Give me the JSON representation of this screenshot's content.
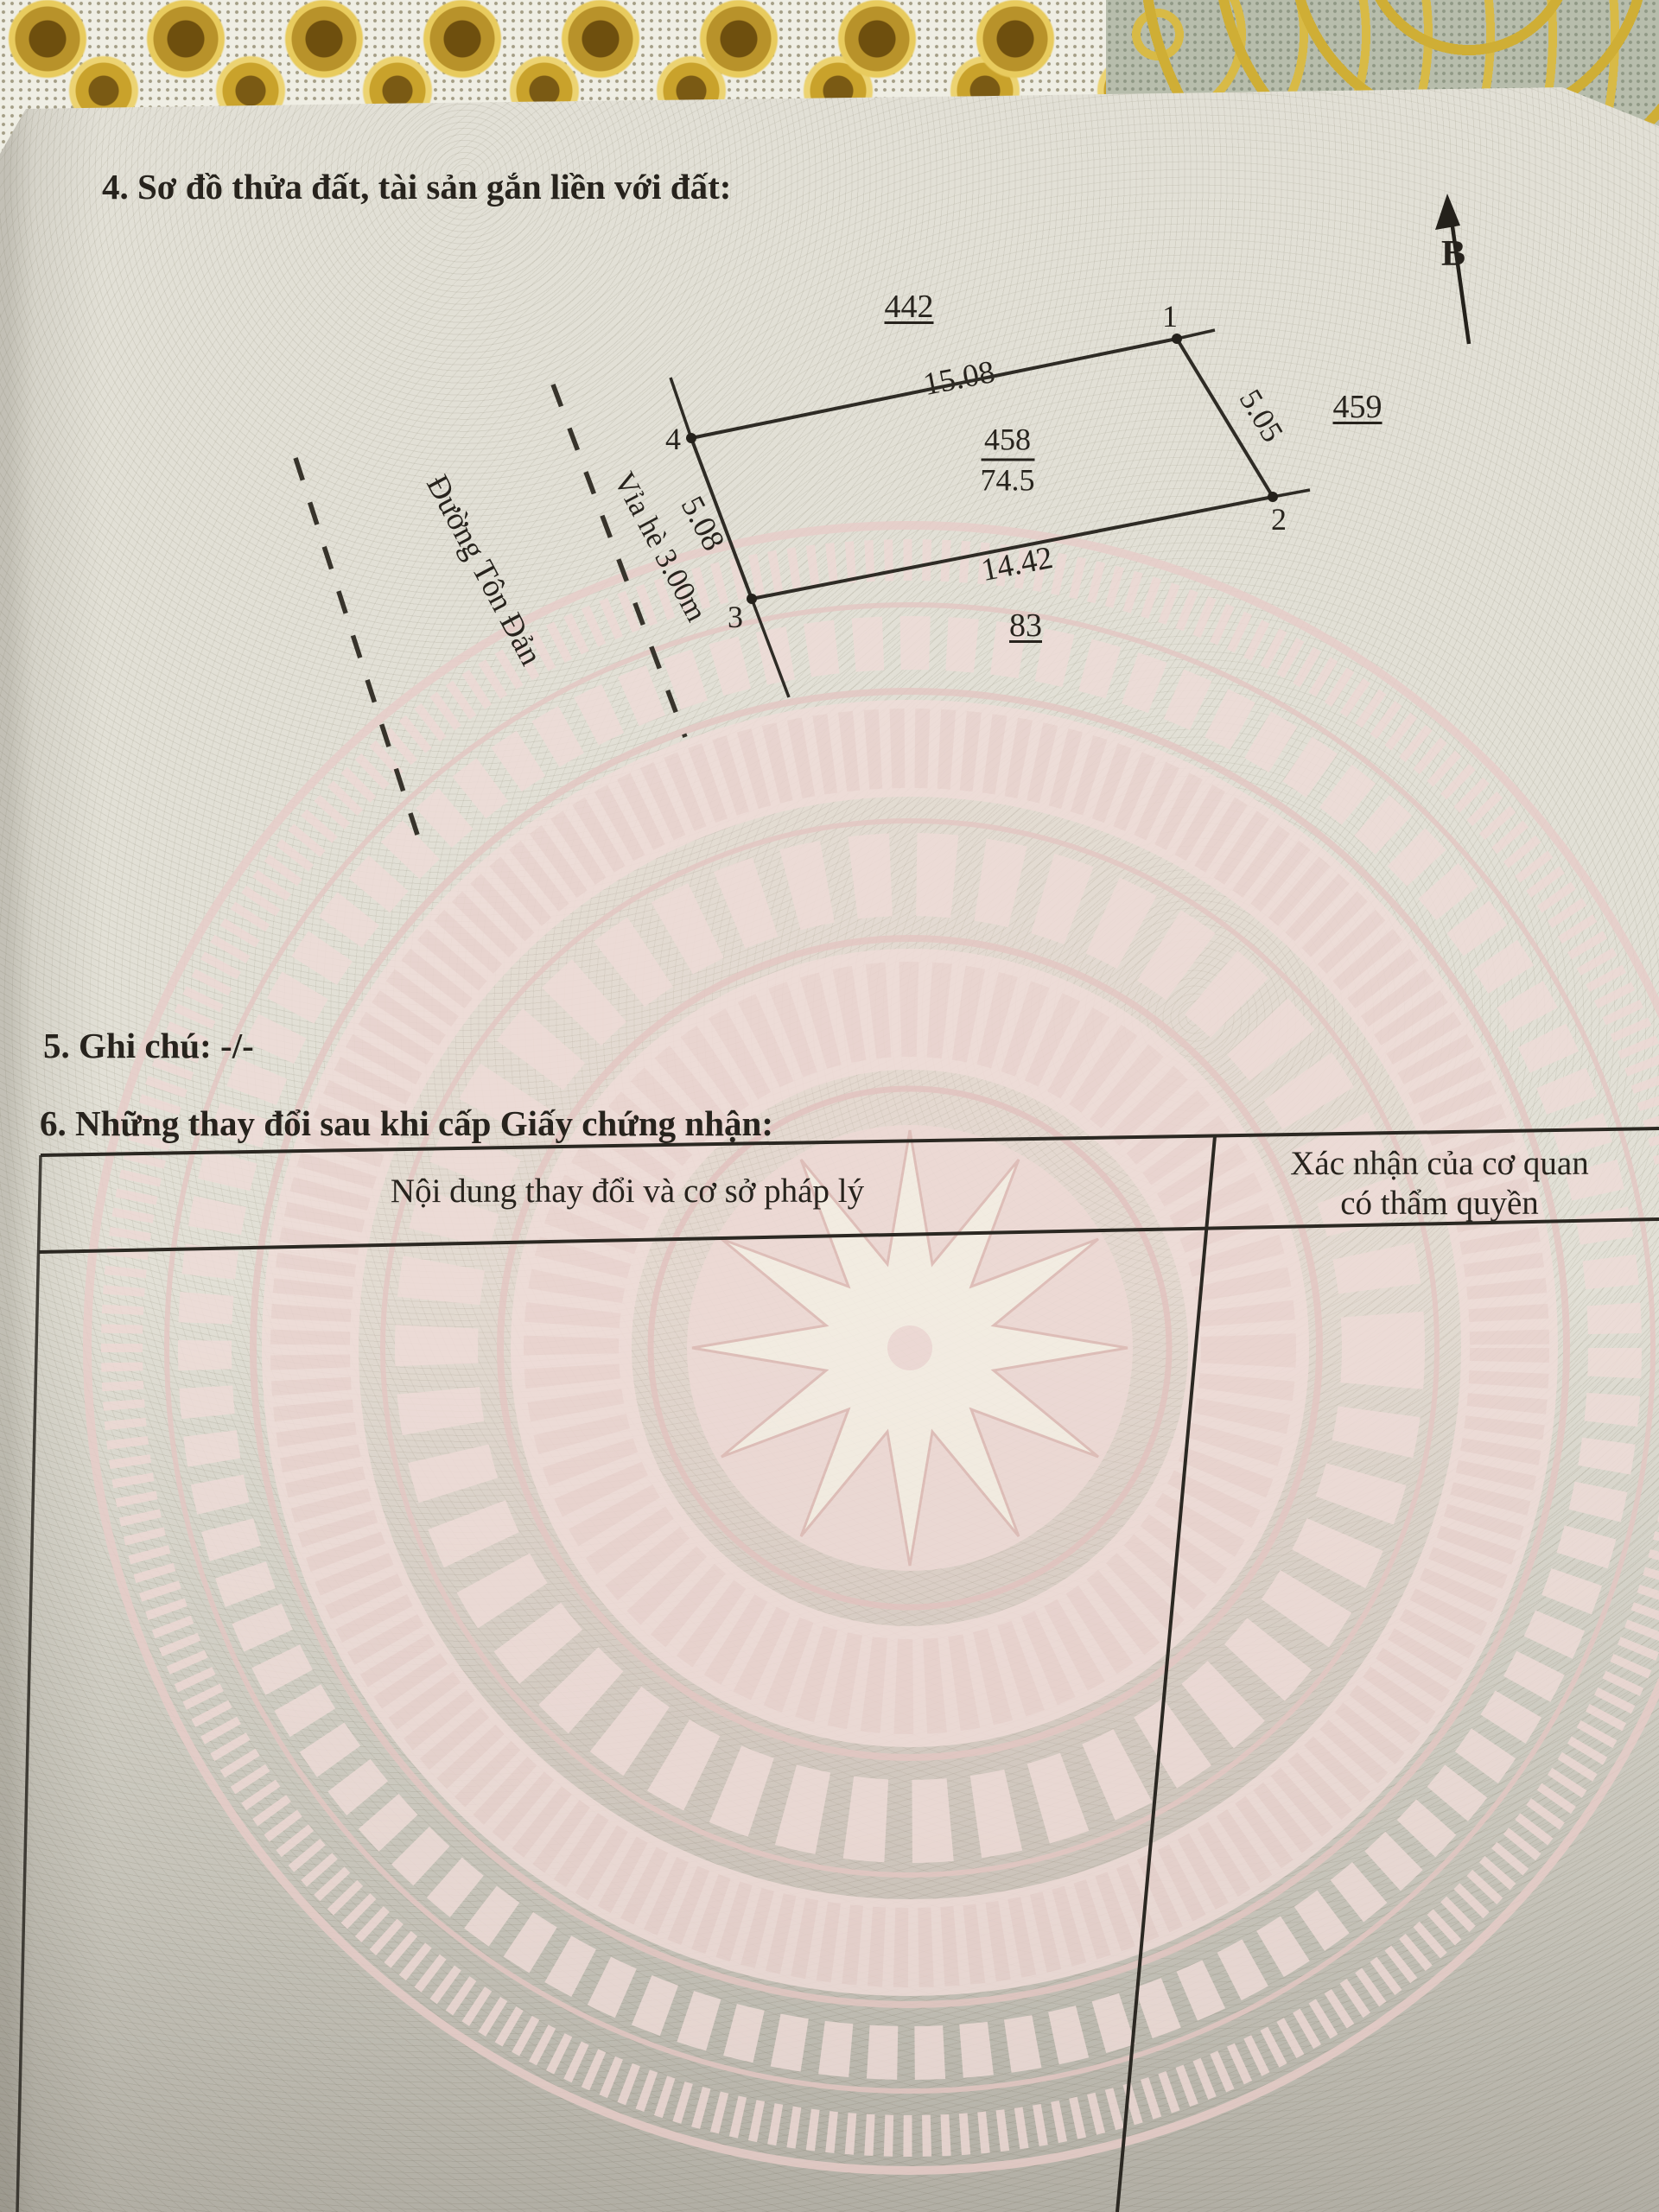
{
  "sections": {
    "s4_title": "4. Sơ đồ thửa đất, tài sản gắn liền với đất:",
    "s5_note": "5. Ghi chú: -/-",
    "s6_title": "6. Những thay đổi sau khi cấp Giấy chứng nhận:"
  },
  "table": {
    "col_content_header": "Nội dung thay đổi và cơ sở pháp lý",
    "col_confirm_header_line1": "Xác nhận của cơ quan",
    "col_confirm_header_line2": "có thẩm quyền"
  },
  "diagram": {
    "north_label": "B",
    "parcel_number": "458",
    "parcel_area": "74.5",
    "adjacent_parcel_top": "442",
    "adjacent_parcel_right": "459",
    "adjacent_parcel_bottom": "83",
    "vertex_1": "1",
    "vertex_2": "2",
    "vertex_3": "3",
    "vertex_4": "4",
    "edge_top_length": "15.08",
    "edge_right_length": "5.05",
    "edge_bottom_length": "14.42",
    "edge_left_length": "5.08",
    "sidewalk_label": "Vỉa hè 3.00m",
    "street_label": "Đường Tôn Đản"
  },
  "colors": {
    "ink": "#27231d",
    "page": "#e2e0d6",
    "drum_pink": "#efdbd7",
    "lace_gold": "#c9a22b"
  }
}
